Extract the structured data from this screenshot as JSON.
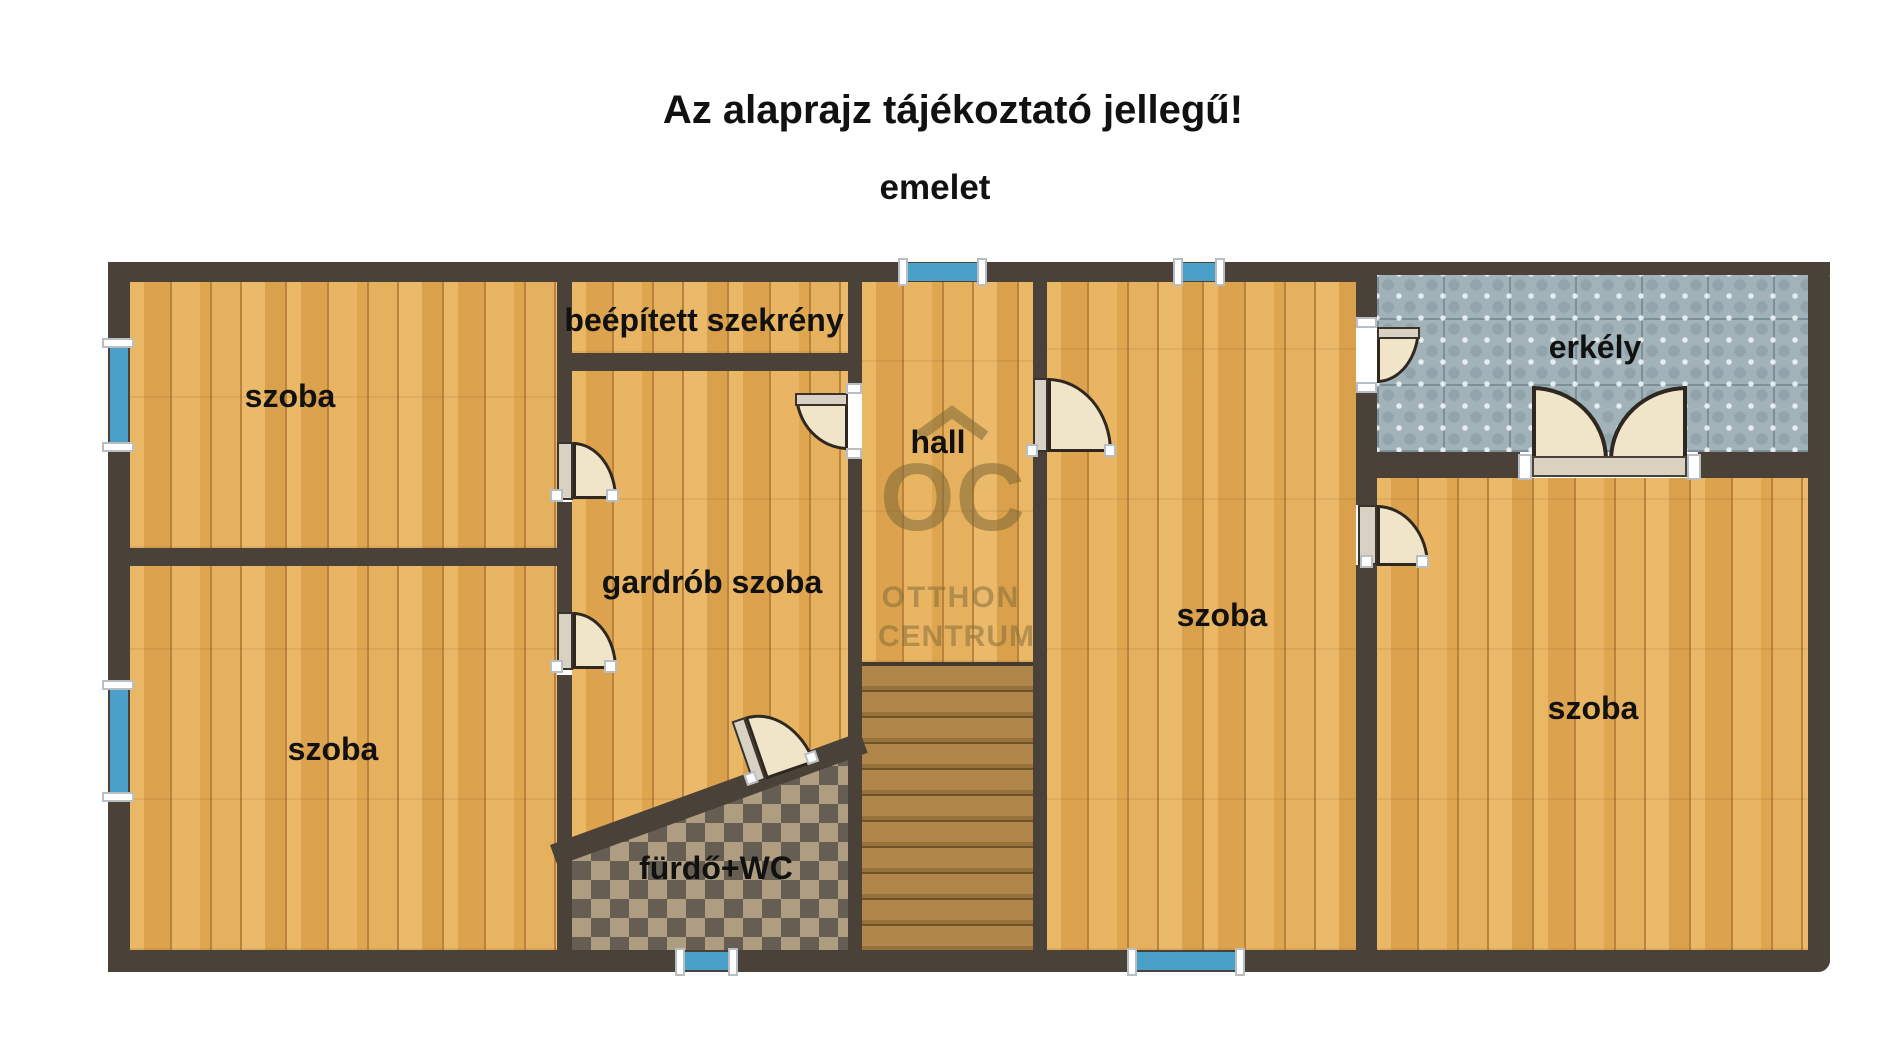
{
  "labels": {
    "title": "Az alaprajz tájékoztató jellegű!",
    "subtitle": "emelet"
  },
  "rooms": {
    "room_top_left": {
      "label": "szoba"
    },
    "built_in_wardrobe": {
      "label": "beépített szekrény"
    },
    "hall": {
      "label": "hall"
    },
    "walk_in_closet": {
      "label": "gardrób szoba"
    },
    "room_bottom_left": {
      "label": "szoba"
    },
    "room_center": {
      "label": "szoba"
    },
    "balcony": {
      "label": "erkély"
    },
    "room_right": {
      "label": "szoba"
    },
    "bathroom": {
      "label": "fürdő+WC"
    }
  },
  "watermark": {
    "monogram": "OC",
    "line1": "OTTHON",
    "line2": "CENTRUM",
    "icon": "house-roof-icon",
    "color": "#7d6836"
  },
  "stairs": {
    "step_count": 11
  },
  "windows": {
    "count": 6
  },
  "doors": {
    "single_count": 7,
    "double_count": 1
  },
  "colors": {
    "wall": "#4a4138",
    "wood_floor": "#e4ab55",
    "window_glass": "#4ba0c9",
    "balcony_tile": "#a2b2b9",
    "bathroom_tile_dark": "#665e53",
    "bathroom_tile_light": "#ae9d80",
    "door_swing": "#f1e5c9",
    "stair_tread": "#b1864a",
    "label_text": "#111111",
    "background": "#ffffff"
  }
}
